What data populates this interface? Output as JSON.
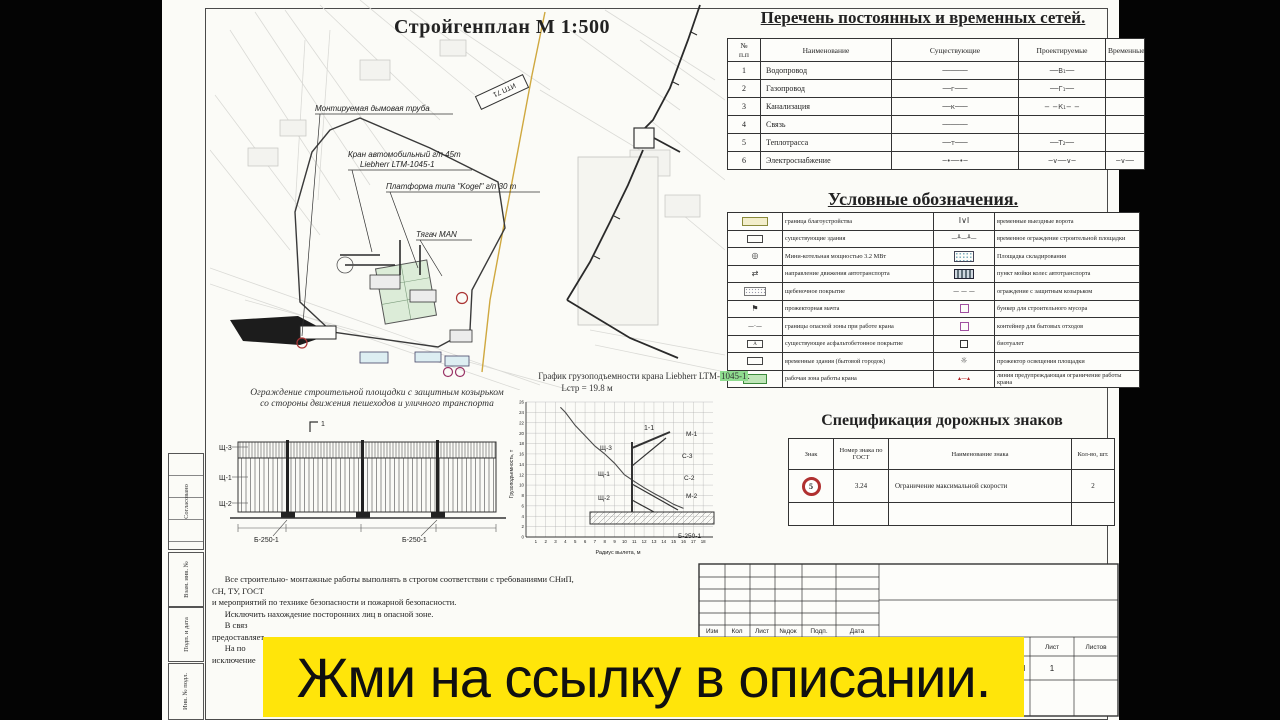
{
  "banner": {
    "text": "Жми на ссылку в описании.",
    "bg": "#ffe50a"
  },
  "plan": {
    "title": "Стройгенплан М 1:500",
    "labels": {
      "chimney": "Монтируемая дымовая труба",
      "crane_line1": "Кран  автомобильный  г/п  45т",
      "crane_line2": "Liebherr  LTM-1045-1",
      "platform": "Платформа типа \"Kogel\"  г/п 30 т",
      "tractor": "Тягач MAN",
      "itp": "ИТП 71"
    }
  },
  "networks": {
    "title": "Перечень постоянных и временных сетей.",
    "headers": [
      "№\nп.п",
      "Наименование",
      "Существующие",
      "Проектируемые",
      "Временные"
    ],
    "rows": [
      {
        "n": "1",
        "name": "Водопровод",
        "ex": "──────",
        "pr": "──В₁──",
        "tmp": ""
      },
      {
        "n": "2",
        "name": "Газопровод",
        "ex": "──г───",
        "pr": "──Г₁──",
        "tmp": ""
      },
      {
        "n": "3",
        "name": "Канализация",
        "ex": "──к───",
        "pr": "− −К₁− −",
        "tmp": ""
      },
      {
        "n": "4",
        "name": "Связь",
        "ex": "──────",
        "pr": "",
        "tmp": ""
      },
      {
        "n": "5",
        "name": "Теплотрасса",
        "ex": "──т───",
        "pr": "──Т₂──",
        "tmp": ""
      },
      {
        "n": "6",
        "name": "Электроснабжение",
        "ex": "─•──•─",
        "pr": "─∨──∨─",
        "tmp": "─∨──"
      }
    ]
  },
  "legend": {
    "title": "Условные обозначения.",
    "rows": [
      {
        "ls": "beige",
        "lt": "граница благоустройства",
        "rs": "gate",
        "rt": "временные выездные ворота"
      },
      {
        "ls": "smallbox",
        "lt": "существующие здания",
        "rs": "posts",
        "rt": "временное ограждение строительной площадки"
      },
      {
        "ls": "boiler",
        "lt": "Мини-котельная мощностью 3.2 МВт",
        "rs": "storage",
        "rt": "Площадка складирования"
      },
      {
        "ls": "arrows",
        "lt": "направление движения автотранспорта",
        "rs": "wash",
        "rt": "пункт мойки колес автотранспорта"
      },
      {
        "ls": "gravel",
        "lt": "щебеночное покрытие",
        "rs": "dashes",
        "rt": "ограждение с защитным козырьком"
      },
      {
        "ls": "mast",
        "lt": "прожекторная мачта",
        "rs": "bunker",
        "rt": "бункер для строительного мусора"
      },
      {
        "ls": "dashdot",
        "lt": "границы опасной зоны при работе крана",
        "rs": "container",
        "rt": "контейнер для бытовых отходов"
      },
      {
        "ls": "asphalt",
        "lt": "существующее асфальтобетонное покрытие",
        "rs": "toilet",
        "rt": "биотуалет"
      },
      {
        "ls": "cabins",
        "lt": "временные здания (бытовой городок)",
        "rs": "light",
        "rt": "прожектор освещения площадки"
      },
      {
        "ls": "green",
        "lt": "рабочая зона работы крана",
        "rs": "warn",
        "rt": "линия предупреждающая ограничение работы крана"
      }
    ]
  },
  "chart_data": {
    "type": "line",
    "title": "График грузоподъемности крана Liebherr LTM-1045-1",
    "title_prefix": "График грузоподъемности крана Liebherr LTM-",
    "title_highlight": "1045-1",
    "title_period": ".",
    "subtitle": "Lстр = 19.8 м",
    "xlabel": "Радиус вылета, м",
    "ylabel": "Грузоподъемность, т",
    "xlim": [
      0,
      19
    ],
    "ylim": [
      0,
      26
    ],
    "x_ticks": [
      1,
      2,
      3,
      4,
      5,
      6,
      7,
      8,
      9,
      10,
      11,
      12,
      13,
      14,
      15,
      16,
      17,
      18
    ],
    "y_ticks": [
      0,
      2,
      4,
      6,
      8,
      10,
      12,
      14,
      16,
      18,
      20,
      22,
      24,
      26
    ],
    "x": [
      3.5,
      4,
      5,
      6,
      7,
      8,
      9,
      10,
      11,
      12,
      13,
      14,
      15,
      16
    ],
    "y": [
      25,
      24,
      21.5,
      19.5,
      17.5,
      16,
      14.2,
      12,
      10.7,
      9.5,
      8.4,
      7.4,
      6.3,
      5.5
    ],
    "grid": true,
    "legend_position": "none"
  },
  "road_signs": {
    "title": "Спецификация дорожных знаков",
    "headers": [
      "Знак",
      "Номер знака по ГОСТ",
      "Наименование знака",
      "Кол-во, шт."
    ],
    "rows": [
      {
        "sign": "5",
        "gost": "3.24",
        "name": "Ограничение максимальной скорости",
        "qty": "2"
      }
    ]
  },
  "fence": {
    "caption_line1": "Ограждение строительной площадки с защитным козырьком",
    "caption_line2": "со стороны движения пешеходов и уличного транспорта",
    "view_mark": "1",
    "section_mark": "1-1",
    "elevation_labels": [
      "Щ-3",
      "Щ-1",
      "Щ-2",
      "Б-250-1",
      "Б-250-1"
    ],
    "section_labels": [
      "Щ-3",
      "М-1",
      "С-3",
      "Щ-1",
      "С-2",
      "Щ-2",
      "М-2",
      "Б-250-1"
    ]
  },
  "notes": {
    "lines": [
      "      Все строительно- монтажные работы выполнять в строгом соответствии с требованиями СНиП,",
      "СН, ТУ, ГОСТ",
      "и мероприятий по технике безопасности и пожарной безопасности.",
      "      Исключить нахождение посторонних лиц в опасной зоне.",
      "      В связ",
      "предоставляет",
      "      На по",
      "исключение"
    ]
  },
  "titleblock": {
    "bottom_headers": [
      "Изм",
      "Кол",
      "Лист",
      "№док",
      "Подп.",
      "Дата"
    ],
    "sheet_header": "Лист",
    "sheets_header": "Листов",
    "sheet_value": "1",
    "stage_value": "М"
  },
  "side_strip": {
    "labels": [
      "Согласовано",
      "Взам. инв. №",
      "Подп. и дата",
      "Инв. № подл."
    ]
  }
}
